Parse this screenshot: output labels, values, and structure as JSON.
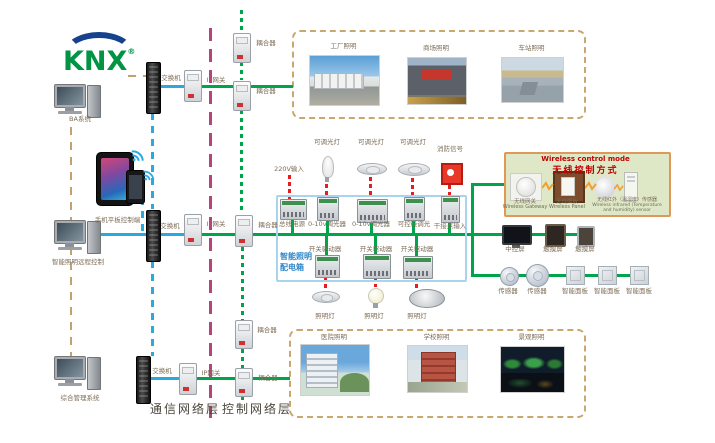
{
  "logo": {
    "text": "KNX",
    "reg": "®"
  },
  "left_devices": {
    "ba_system": "BA系统",
    "mobile_control": "手机平板控制端",
    "remote_control": "智能照明远程控制",
    "management_system": "综合管理系统"
  },
  "network_labels": {
    "switch": "交换机",
    "ip_gateway": "IP网关",
    "coupler": "耦合器"
  },
  "layer_labels": {
    "communication": "通信网络层",
    "control": "控制网络层"
  },
  "top_photos": {
    "items": [
      {
        "label": "工厂照明"
      },
      {
        "label": "商场照明"
      },
      {
        "label": "车站照明"
      }
    ]
  },
  "bottom_photos": {
    "items": [
      {
        "label": "医院照明"
      },
      {
        "label": "学校照明"
      },
      {
        "label": "景观照明"
      }
    ]
  },
  "distribution_box": {
    "title_line1": "智能照明",
    "title_line2": "配电箱",
    "power_input": "220V输入",
    "top_lamps": [
      "可调光灯",
      "可调光灯",
      "可调光灯"
    ],
    "fire_signal": "消防信号",
    "row1": [
      "总线电源",
      "0-10v调光器",
      "0-10v调光器",
      "可控硅调光",
      "干接点输入"
    ],
    "row2": [
      "开关驱动器",
      "开关驱动器",
      "开关驱动器"
    ],
    "bottom_lamps": [
      "照明灯",
      "照明灯",
      "照明灯"
    ]
  },
  "wireless_panel": {
    "title_en": "Wireless control mode",
    "title_zh": "无线控制方式",
    "devices": [
      {
        "zh": "无线网关",
        "en": "Wireless Gateway"
      },
      {
        "zh": "无线面板",
        "en": "Wireless Panel"
      },
      {
        "zh": "无线红外（温湿度）传感器",
        "en": "Wireless infrared (Temperature and humidity) sensor"
      }
    ]
  },
  "control_devices": {
    "row1": [
      "中控屏",
      "触摸屏",
      "触摸屏"
    ],
    "row2": [
      "传感器",
      "传感器",
      "智能面板",
      "智能面板",
      "智能面板"
    ]
  }
}
